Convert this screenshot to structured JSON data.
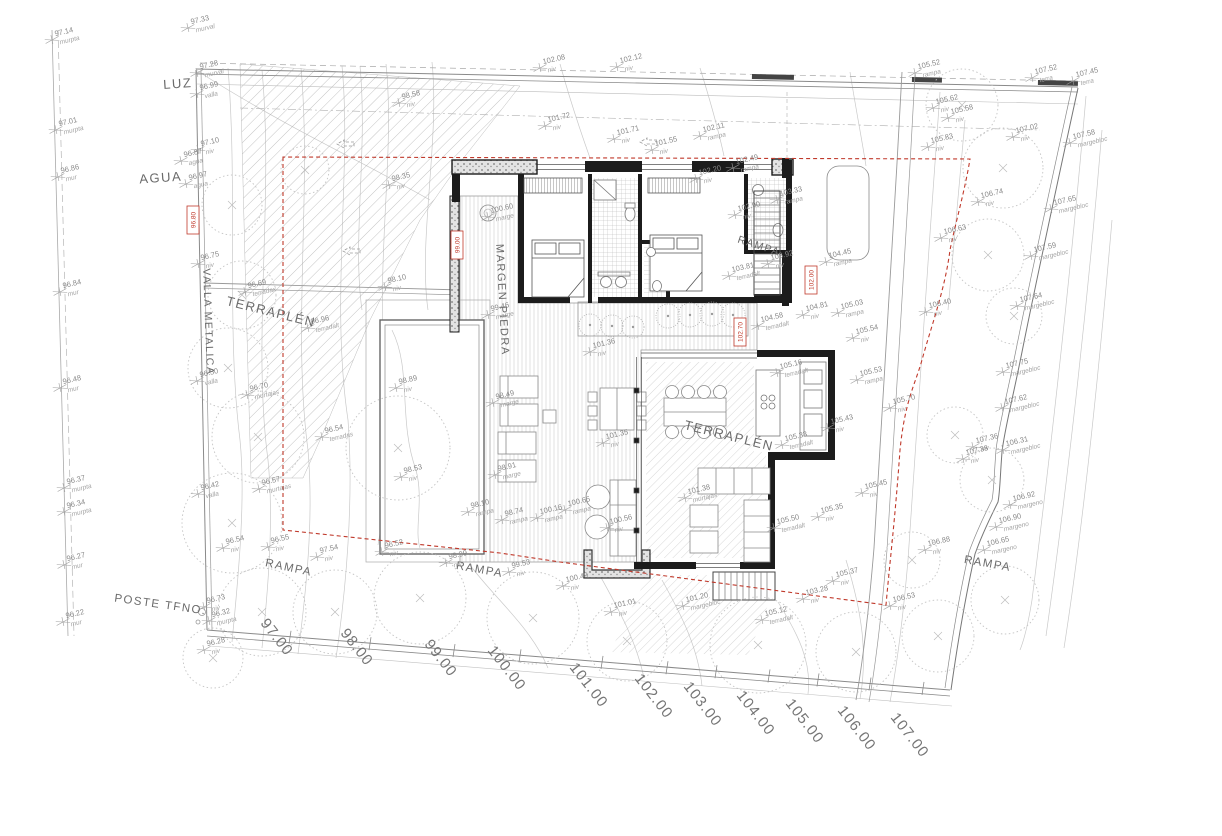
{
  "drawing": {
    "kind": "architectural site plan with house floor plan",
    "colors": {
      "boundary_red": "#c0392b",
      "wall_black": "#1c1c1c",
      "line_gray": "#999999",
      "contour_gray": "#c9c9c9"
    },
    "labels": [
      {
        "text": "LUZ",
        "x": 178,
        "y": 88,
        "rot": -4,
        "size": 13
      },
      {
        "text": "AGUA",
        "x": 161,
        "y": 182,
        "rot": -4,
        "size": 13
      },
      {
        "text": "VALLA METALICA",
        "x": 205,
        "y": 322,
        "rot": 88,
        "size": 10.5
      },
      {
        "text": "TERRAPLÉN",
        "x": 270,
        "y": 316,
        "rot": 14,
        "size": 13
      },
      {
        "text": "TERRAPLÉN",
        "x": 728,
        "y": 440,
        "rot": 14,
        "size": 13
      },
      {
        "text": "MARGEN PIEDRA",
        "x": 499,
        "y": 300,
        "rot": 87,
        "size": 11
      },
      {
        "text": "RAMPA",
        "x": 758,
        "y": 249,
        "rot": 18,
        "size": 10.5
      },
      {
        "text": "RAMPA",
        "x": 288,
        "y": 571,
        "rot": 12,
        "size": 11.5
      },
      {
        "text": "RAMPA",
        "x": 479,
        "y": 573,
        "rot": 10,
        "size": 11.5
      },
      {
        "text": "RAMPA",
        "x": 987,
        "y": 567,
        "rot": 10,
        "size": 11.5
      },
      {
        "text": "POSTE TFNO.",
        "x": 160,
        "y": 608,
        "rot": 8,
        "size": 11.5
      }
    ],
    "street_elevations": {
      "rotation": 52,
      "marks": [
        {
          "v": "97.00",
          "x": 273,
          "y": 640
        },
        {
          "v": "98.00",
          "x": 353,
          "y": 650
        },
        {
          "v": "99.00",
          "x": 437,
          "y": 661
        },
        {
          "v": "100.00",
          "x": 503,
          "y": 671
        },
        {
          "v": "101.00",
          "x": 585,
          "y": 688
        },
        {
          "v": "102.00",
          "x": 650,
          "y": 699
        },
        {
          "v": "103.00",
          "x": 699,
          "y": 707
        },
        {
          "v": "104.00",
          "x": 752,
          "y": 716
        },
        {
          "v": "105.00",
          "x": 801,
          "y": 724
        },
        {
          "v": "106.00",
          "x": 853,
          "y": 731
        },
        {
          "v": "107.00",
          "x": 906,
          "y": 738
        }
      ]
    },
    "red_markers": [
      {
        "x": 193,
        "y": 220,
        "v": "96.80"
      },
      {
        "x": 457,
        "y": 245,
        "v": "99.00"
      },
      {
        "x": 740,
        "y": 332,
        "v": "102.70"
      },
      {
        "x": 811,
        "y": 280,
        "v": "102.00"
      }
    ],
    "survey_points": [
      [
        52,
        40,
        "97.14",
        "murpta"
      ],
      [
        56,
        130,
        "97.01",
        "murpta"
      ],
      [
        58,
        177,
        "96.86",
        "mur"
      ],
      [
        60,
        292,
        "96.84",
        "mur"
      ],
      [
        60,
        388,
        "96.48",
        "mur"
      ],
      [
        64,
        488,
        "96.37",
        "murpta"
      ],
      [
        64,
        512,
        "96.34",
        "murpta"
      ],
      [
        64,
        565,
        "96.27",
        "mur"
      ],
      [
        63,
        622,
        "96.22",
        "mur"
      ],
      [
        188,
        28,
        "97.33",
        "murval"
      ],
      [
        197,
        73,
        "97.28",
        "murval"
      ],
      [
        197,
        94,
        "96.99",
        "valla"
      ],
      [
        198,
        150,
        "97.10",
        "niv"
      ],
      [
        181,
        161,
        "96.87",
        "agua"
      ],
      [
        186,
        184,
        "96.97",
        "agua"
      ],
      [
        198,
        264,
        "96.75",
        "niv"
      ],
      [
        197,
        381,
        "96.50",
        "valla"
      ],
      [
        198,
        494,
        "96.42",
        "valla"
      ],
      [
        223,
        548,
        "96.54",
        "niv"
      ],
      [
        204,
        607,
        "96.73",
        "niv"
      ],
      [
        209,
        621,
        "96.32",
        "murpta"
      ],
      [
        204,
        650,
        "96.28",
        "niv"
      ],
      [
        245,
        292,
        "96.69",
        "terradax"
      ],
      [
        308,
        328,
        "96.96",
        "terradalt"
      ],
      [
        247,
        395,
        "96.70",
        "murtajas"
      ],
      [
        322,
        437,
        "96.54",
        "terradas"
      ],
      [
        259,
        489,
        "96.57",
        "murtajas"
      ],
      [
        268,
        547,
        "96.55",
        "niv"
      ],
      [
        317,
        557,
        "97.54",
        "niv"
      ],
      [
        382,
        552,
        "96.52",
        "niv"
      ],
      [
        446,
        563,
        "98.99",
        "niv"
      ],
      [
        399,
        103,
        "98.58",
        "niv"
      ],
      [
        389,
        185,
        "98.35",
        "niv"
      ],
      [
        385,
        287,
        "98.10",
        "niv"
      ],
      [
        396,
        388,
        "98.89",
        "niv"
      ],
      [
        401,
        477,
        "98.53",
        "niv"
      ],
      [
        488,
        217,
        "100.60",
        "marge"
      ],
      [
        488,
        315,
        "99.46",
        "marge"
      ],
      [
        493,
        403,
        "98.49",
        "marge"
      ],
      [
        495,
        475,
        "98.91",
        "marge"
      ],
      [
        468,
        512,
        "98.10",
        "rampa"
      ],
      [
        502,
        520,
        "98.74",
        "rampa"
      ],
      [
        537,
        518,
        "100.16",
        "rampa"
      ],
      [
        565,
        510,
        "100.65",
        "rampa"
      ],
      [
        607,
        528,
        "100.56",
        "niv"
      ],
      [
        603,
        443,
        "101.35",
        "niv"
      ],
      [
        590,
        352,
        "101.36",
        "niv"
      ],
      [
        685,
        498,
        "101.38",
        "murtajas"
      ],
      [
        611,
        612,
        "101.01",
        "niv"
      ],
      [
        563,
        586,
        "100.49",
        "niv"
      ],
      [
        509,
        572,
        "99.53",
        "niv"
      ],
      [
        540,
        68,
        "102.08",
        "niv"
      ],
      [
        617,
        67,
        "102.12",
        "niv"
      ],
      [
        545,
        126,
        "101.72",
        "niv"
      ],
      [
        614,
        139,
        "101.71",
        "niv"
      ],
      [
        700,
        136,
        "102.11",
        "rampa"
      ],
      [
        652,
        150,
        "101.55",
        "niv"
      ],
      [
        733,
        168,
        "102.49",
        "rampa"
      ],
      [
        696,
        179,
        "102.20",
        "niv"
      ],
      [
        735,
        215,
        "102.90",
        "niv"
      ],
      [
        777,
        200,
        "103.33",
        "rampa"
      ],
      [
        768,
        264,
        "103.92",
        "niv"
      ],
      [
        729,
        276,
        "103.81",
        "terradalt"
      ],
      [
        758,
        326,
        "104.58",
        "terradalt"
      ],
      [
        803,
        315,
        "104.81",
        "niv"
      ],
      [
        826,
        262,
        "104.45",
        "rampa"
      ],
      [
        838,
        313,
        "105.03",
        "rampa"
      ],
      [
        853,
        338,
        "105.54",
        "niv"
      ],
      [
        777,
        373,
        "105.16",
        "terradalt"
      ],
      [
        857,
        380,
        "105.53",
        "rampa"
      ],
      [
        890,
        408,
        "105.70",
        "niv"
      ],
      [
        828,
        428,
        "105.43",
        "niv"
      ],
      [
        782,
        445,
        "105.33",
        "terradalt"
      ],
      [
        862,
        493,
        "105.45",
        "niv"
      ],
      [
        818,
        517,
        "105.35",
        "niv"
      ],
      [
        774,
        528,
        "105.50",
        "terradalt"
      ],
      [
        833,
        581,
        "105.37",
        "niv"
      ],
      [
        925,
        550,
        "106.88",
        "niv"
      ],
      [
        890,
        606,
        "106.53",
        "niv"
      ],
      [
        803,
        599,
        "103.28",
        "niv"
      ],
      [
        762,
        620,
        "105.12",
        "terradalt"
      ],
      [
        683,
        606,
        "101.20",
        "margebloc"
      ],
      [
        915,
        73,
        "105.52",
        "rampa"
      ],
      [
        1032,
        78,
        "107.52",
        "terra"
      ],
      [
        1073,
        81,
        "107.45",
        "terra"
      ],
      [
        933,
        108,
        "105.62",
        "niv"
      ],
      [
        948,
        118,
        "105.58",
        "niv"
      ],
      [
        928,
        147,
        "105.83",
        "niv"
      ],
      [
        1013,
        137,
        "107.02",
        "niv"
      ],
      [
        1070,
        143,
        "107.58",
        "margebloc"
      ],
      [
        978,
        202,
        "106.74",
        "niv"
      ],
      [
        1051,
        209,
        "107.65",
        "margebloc"
      ],
      [
        941,
        238,
        "106.63",
        "niv"
      ],
      [
        1031,
        256,
        "107.59",
        "margebloc"
      ],
      [
        1017,
        306,
        "107.64",
        "margebloc"
      ],
      [
        926,
        312,
        "106.40",
        "niv"
      ],
      [
        1003,
        372,
        "107.75",
        "margebloc"
      ],
      [
        1002,
        408,
        "107.62",
        "margebloc"
      ],
      [
        1003,
        450,
        "106.31",
        "margebloc"
      ],
      [
        973,
        447,
        "107.36",
        "niv"
      ],
      [
        963,
        459,
        "107.38",
        "niv"
      ],
      [
        1010,
        505,
        "106.92",
        "margeno"
      ],
      [
        996,
        527,
        "106.90",
        "margeno"
      ],
      [
        984,
        550,
        "106.65",
        "margeno"
      ]
    ],
    "trees": [
      [
        232,
        205,
        30
      ],
      [
        242,
        295,
        34
      ],
      [
        228,
        368,
        40
      ],
      [
        258,
        437,
        46
      ],
      [
        232,
        523,
        50
      ],
      [
        262,
        612,
        44
      ],
      [
        335,
        612,
        42
      ],
      [
        420,
        598,
        46
      ],
      [
        533,
        618,
        46
      ],
      [
        627,
        641,
        40
      ],
      [
        758,
        645,
        48
      ],
      [
        856,
        652,
        40
      ],
      [
        938,
        636,
        36
      ],
      [
        1005,
        600,
        34
      ],
      [
        912,
        560,
        28
      ],
      [
        962,
        105,
        36
      ],
      [
        1003,
        168,
        40
      ],
      [
        988,
        255,
        36
      ],
      [
        1014,
        316,
        28
      ],
      [
        955,
        435,
        28
      ],
      [
        992,
        480,
        32
      ],
      [
        398,
        448,
        52
      ],
      [
        213,
        658,
        30
      ],
      [
        305,
        170,
        24
      ]
    ],
    "bushes": [
      [
        590,
        325,
        11
      ],
      [
        612,
        326,
        11
      ],
      [
        633,
        327,
        11
      ],
      [
        668,
        316,
        12
      ],
      [
        690,
        315,
        12
      ],
      [
        712,
        314,
        12
      ],
      [
        733,
        315,
        12
      ]
    ],
    "arrows": [
      [
        345,
        144
      ],
      [
        351,
        251
      ],
      [
        648,
        142
      ]
    ]
  }
}
